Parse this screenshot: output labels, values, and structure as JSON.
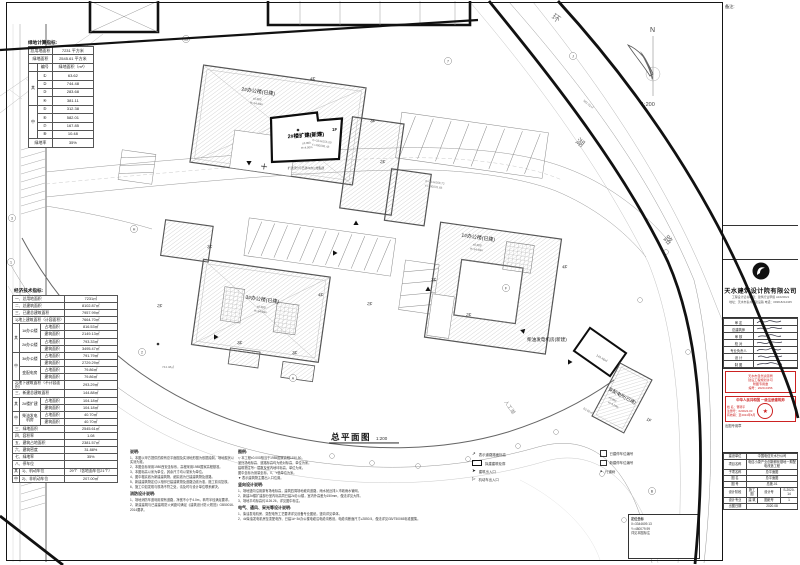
{
  "drawing": {
    "title": "总平面图",
    "scale": "1:200",
    "north_label": "N",
    "north_scale": "1:200",
    "road_name": {
      "c1": "环",
      "c2": "湖",
      "c3": "路"
    },
    "lake_label": "人工湖",
    "floors": {
      "f1": "1F",
      "f2": "2F",
      "f3": "3F",
      "f4": "4F"
    },
    "buildings": {
      "b2": {
        "name": "2#办公楼(已建)",
        "e1": "±0.000",
        "e2": "H=14.40m"
      },
      "ext": {
        "name": "2#楼扩建(新建)",
        "e1": "±0.000",
        "e2": "H=4.50m",
        "note": "扩建部分与已建2#办公楼贴建"
      },
      "b3": {
        "name": "3#办公楼(已建)",
        "e1": "±0.000",
        "e2": "H=14.40m"
      },
      "b1": {
        "name": "1#办公楼(已建)",
        "e1": "±0.000",
        "e2": "H=14.40m"
      },
      "gen": {
        "name": "柴油发电机房(新建)",
        "area": "144.46㎡"
      },
      "sub": {
        "name": "变配电所(已建)",
        "e1": "±0.000",
        "e2": "H=4.20m"
      }
    },
    "coords": {
      "c1x": "X=3344555.09",
      "c1y": "Y=480098.48",
      "c2x": "X=3344568.72",
      "c2y": "Y=480076.66"
    },
    "areas": {
      "top": "582.01㎡",
      "mid": "744.48㎡",
      "low": "63.62㎡"
    },
    "bubbles": [
      "7",
      "J",
      "13",
      "1",
      "2",
      "H",
      "A",
      "F",
      "B",
      "3"
    ],
    "coordbox": {
      "t": "定位坐标",
      "l1": "X=3344609.13",
      "l2": "Y=480079.99",
      "l3": "详见本图标注"
    }
  },
  "green": {
    "title": "绿地计算指标:",
    "land_l": "总用地面积",
    "land_v": "7231 平方米",
    "green_l": "绿地面积",
    "green_v": "2545.61 平方米",
    "num_h": "编号",
    "area_h": "绿地面积（m²）",
    "qi": "其",
    "zhong": "中",
    "items": [
      {
        "n": "①",
        "v": "63.62"
      },
      {
        "n": "②",
        "v": "744.48"
      },
      {
        "n": "③",
        "v": "283.68"
      },
      {
        "n": "④",
        "v": "381.11"
      },
      {
        "n": "⑤",
        "v": "312.38"
      },
      {
        "n": "⑥",
        "v": "582.01"
      },
      {
        "n": "⑦",
        "v": "167.85"
      },
      {
        "n": "⑧",
        "v": "10.48"
      }
    ],
    "rate_l": "绿地率",
    "rate_v": "35%"
  },
  "econ": {
    "title": "经济技术指标:",
    "qi": "其",
    "zhong": "中",
    "zhan": "占地面积",
    "jian": "建筑面积",
    "rows": {
      "total_land": {
        "l": "一、总用地面积",
        "v": "7231㎡"
      },
      "total_build": {
        "l": "二、总建筑面积",
        "v": "8102.87㎡"
      },
      "built_total": {
        "l": "三、已建总建筑面积",
        "v": "7957.99㎡"
      },
      "above": {
        "l": "1)地上建筑面积（计容面积）",
        "v": "7664.70㎡"
      },
      "below": {
        "l": "2)地下建筑面积（不计容面积）",
        "v": "293.29㎡"
      },
      "new_total": {
        "l": "三、新建总建筑面积",
        "v": "144.88㎡"
      },
      "green": {
        "l": "三、绿地面积",
        "v": "2545.61㎡"
      },
      "far": {
        "l": "四、容积率",
        "v": "1.08"
      },
      "footprint": {
        "l": "五、建筑占地面积",
        "v": "2381.57㎡"
      },
      "density": {
        "l": "六、建筑密度",
        "v": "31.88%"
      },
      "green_rate": {
        "l": "七、绿地率",
        "v": "35%"
      },
      "parking": {
        "l": "八、停车位",
        "v": ""
      },
      "moto": {
        "l": "1)、机动车位",
        "v": "29个（含地面车位21个）"
      },
      "nonmoto": {
        "l": "2)、非机动车位",
        "v": "207.00㎡"
      }
    },
    "bldgs": {
      "b1": {
        "n": "1#办公楼",
        "z": "816.53㎡",
        "j": "2149.13㎡"
      },
      "b2": {
        "n": "2#办公楼",
        "z": "793.33㎡",
        "j": "3495.47㎡"
      },
      "b3": {
        "n": "3#办公楼",
        "z": "791.79㎡",
        "j": "2729.29㎡"
      },
      "sub": {
        "n": "变配电房",
        "z": "79.86㎡",
        "j": "79.86㎡"
      },
      "ext": {
        "n": "2#楼扩建",
        "z": "104.18㎡",
        "j": "104.18㎡"
      },
      "gen": {
        "n": "柴油发电机房",
        "z": "40.70㎡",
        "j": "40.70㎡"
      }
    }
  },
  "notes": {
    "left": {
      "title": "说明:",
      "items": [
        "1、本图以甲方提供的原有总平面图及实测地形图为依据绘制，场地现状以实测为准。",
        "2、本图坐标采用1980西安坐标系，高程采用1985国家高程基准。",
        "3、本图标高以米为单位，其余尺寸均以毫米为单位。",
        "4、图中粗实线为新建建筑物，细实线为已建建筑物及道路。",
        "5、新建建筑物定位以相邻已建建筑物及道路边线为准，施工前请复核。",
        "6、施工中如发现与现场不符之处，请及时与设计单位联系解决。"
      ],
      "fire_title": "消防设计说明:",
      "fire_items": [
        "1、场地消防车道利用现有道路，净宽不小于4.0m，转弯半径满足要求。",
        "2、新建建筑与已建建筑防火间距均满足《建筑设计防火规范》GB50016-2014要求。"
      ]
    },
    "mid": {
      "title": "图例:",
      "items": [
        "▽ 本工程±0.000相当于1985国家高程1150.50。",
        "室外场地标高、道路标高均为绝对标高，单位为米。",
        "建筑物注写：层数及室内地坪标高，单位为米。",
        "图中坐标为测量坐标，X、Y值单位为米。",
        "▼ 表示建筑物主要出入口位置。"
      ],
      "vertical_title": "竖向设计说明:",
      "vertical_items": [
        "1、场地竖向沿用原有场地标高，建筑四周场地坡向道路，雨水就近排入市政雨水管网。",
        "2、新建2#楼扩建部分室内标高同已建2#办公楼，室内外高差为150mm，做法详见大样。",
        "3、场地平均标高约1126.26，详见图中标注。"
      ],
      "elec_title": "电气、通风、采光等设计说明:",
      "elec_items": [
        "1、柴油发电机房、变配电所工艺要求详见设备专业图纸，竖向详见单体。",
        "2、4#柴油发电机房至变配电所、已建1#~3#办公楼电缆沿电缆沟敷设，电缆沟断面尺寸≥2850.5，做法详见GB/T50065标准图集。"
      ]
    }
  },
  "legend": {
    "items": [
      {
        "label": "表示道路路面标高"
      },
      {
        "label": "拟建建筑轮廓"
      },
      {
        "label": "建筑出入口"
      },
      {
        "label": "机动车出入口"
      }
    ],
    "right_items": [
      {
        "label": "已建停车位编号"
      },
      {
        "label": "新建停车位编号"
      },
      {
        "label": "行道树"
      }
    ]
  },
  "title_block": {
    "remark_label": "备注:",
    "company": "天水建筑设计院有限公司",
    "cert_line": "工程设计证书等级：建筑行业甲级 A1620021",
    "addr_line": "地址：天水市秦州区建设路 电话：0938-8212345",
    "sig_rows": [
      "审 定",
      "总建筑师",
      "审 核",
      "校 对",
      "专业负责人",
      "设 计",
      "制 图"
    ],
    "stamp1_lines": [
      "天水市自然资源局",
      "建设工程规划许可",
      "附图专用章",
      "编号：2020-0456"
    ],
    "stamp2_title": "中华人民共和国 一级注册建筑师",
    "stamp2_name": "姓 名：曹旸平",
    "stamp2_no": "注册号：620022-00",
    "stamp2_valid": "有效期：至2024年6月",
    "seal_star": "★",
    "stamp_caption": "出图专用章",
    "fields": {
      "owner_l": "建设单位",
      "owner_v": "中国电信天水分公司",
      "proj_l": "项目名称",
      "proj_v": "电信小康产业创新孵化基地一期配电改造工程",
      "sub_l": "子项名称",
      "sub_v": "总平面图",
      "name_l": "图 名",
      "name_v": "总平面图",
      "no_l": "图 号",
      "no_v": "总施-01",
      "stage_l": "设计阶段",
      "stage_v": "施工图",
      "dno_l": "设计号",
      "dno_v": "S-2020-14",
      "major_l": "设计专业",
      "major_v": "建 筑",
      "sheet_l": "图纸号",
      "sheet_v": "1",
      "date_l": "出图日期",
      "date_v": "2020.08"
    }
  }
}
